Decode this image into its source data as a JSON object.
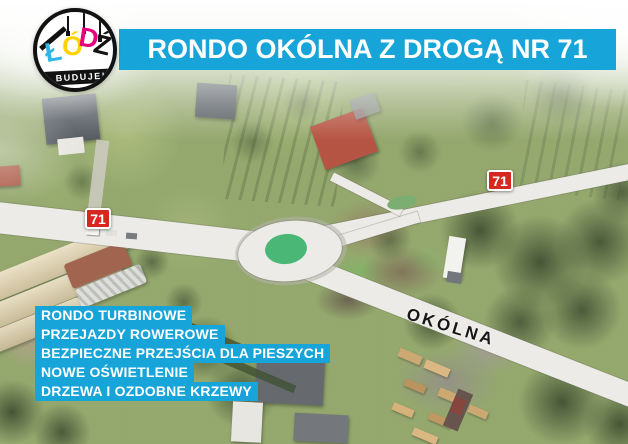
{
  "header": {
    "title": "RONDO OKÓLNA Z DROGĄ NR 71",
    "banner_color": "#17a4d9"
  },
  "logo": {
    "letters": [
      {
        "char": "Ł",
        "color": "#2eb6e8"
      },
      {
        "char": "Ó",
        "color": "#ffd200"
      },
      {
        "char": "D",
        "color": "#e6007e"
      },
      {
        "char": "Ź",
        "color": "#121212"
      }
    ],
    "tagline": "BUDUJE!"
  },
  "map": {
    "type": "aerial-photo-of-turbine-roundabout",
    "street_label": "OKÓLNA",
    "road_badges": [
      {
        "number": "71"
      },
      {
        "number": "71"
      }
    ],
    "badge_color": "#d6281e",
    "roundabout_island_color": "#3fb36f"
  },
  "features": {
    "bar_color": "#17a4d9",
    "items": [
      "RONDO TURBINOWE",
      "PRZEJAZDY ROWEROWE",
      "BEZPIECZNE PRZEJŚCIA DLA PIESZYCH",
      "NOWE OŚWIETLENIE",
      "DRZEWA I OZDOBNE KRZEWY"
    ]
  }
}
